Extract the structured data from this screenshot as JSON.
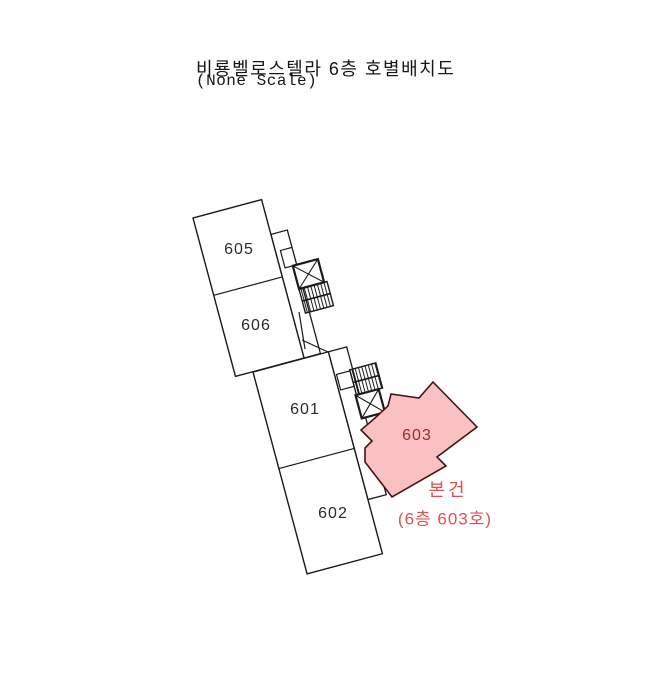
{
  "title": {
    "line1": "비룡벨로스텔라 6층 호별배치도",
    "line2": "(None Scale)"
  },
  "rooms": [
    {
      "label": "605"
    },
    {
      "label": "606"
    },
    {
      "label": "601"
    },
    {
      "label": "602"
    }
  ],
  "highlight_room": {
    "label": "603"
  },
  "annotation": {
    "line1": "본건",
    "line2": "(6층 603호)"
  },
  "facilities": {
    "elevator_count": 2,
    "stairs_count": 2
  },
  "colors": {
    "background": "#ffffff",
    "wall": "#1a1a1a",
    "highlight_fill": "#f9c1c1",
    "highlight_border": "#4a1212",
    "room_label": "#2a2a2a",
    "highlight_label": "#9c2a2a",
    "annotation_red": "#e05050"
  }
}
